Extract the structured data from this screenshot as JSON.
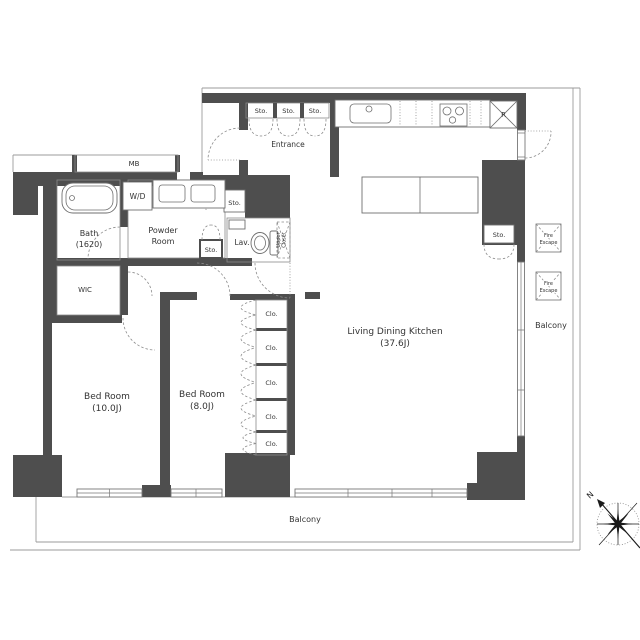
{
  "plan_type": "apartment-floor-plan",
  "colors": {
    "wall": "#4e4e4e",
    "outline": "#8a8a8a",
    "boundary": "#9b9b9b",
    "text": "#333333",
    "background": "#ffffff"
  },
  "rooms": {
    "entrance": {
      "label": "Entrance"
    },
    "bath": {
      "label": "Bath",
      "size": "(1620)"
    },
    "powder_room": {
      "label_line1": "Powder",
      "label_line2": "Room"
    },
    "lavatory": {
      "label": "Lav."
    },
    "wic": {
      "label": "WIC"
    },
    "bedroom_1": {
      "label": "Bed Room",
      "size": "(10.0J)"
    },
    "bedroom_2": {
      "label": "Bed Room",
      "size": "(8.0J)"
    },
    "living_dining_kitchen": {
      "label": "Living Dining Kitchen",
      "size": "(37.6J)"
    }
  },
  "storage": {
    "entrance_sto": [
      "Sto.",
      "Sto.",
      "Sto."
    ],
    "powder_sto": "Sto.",
    "hall_sto": "Sto.",
    "ldk_sto": "Sto.",
    "closets": [
      "Clo.",
      "Clo.",
      "Clo.",
      "Clo.",
      "Clo."
    ],
    "upper_closet_line1": "Upper",
    "upper_closet_line2": "Closet"
  },
  "fixtures": {
    "meter_box": "MB",
    "washer_dryer": "W/D",
    "refrigerator": "R"
  },
  "exterior": {
    "balcony_right": "Balcony",
    "balcony_bottom": "Balcony",
    "fire_escape_1_line1": "Fire",
    "fire_escape_1_line2": "Escape",
    "fire_escape_2_line1": "Fire",
    "fire_escape_2_line2": "Escape"
  },
  "compass": {
    "north": "N"
  }
}
